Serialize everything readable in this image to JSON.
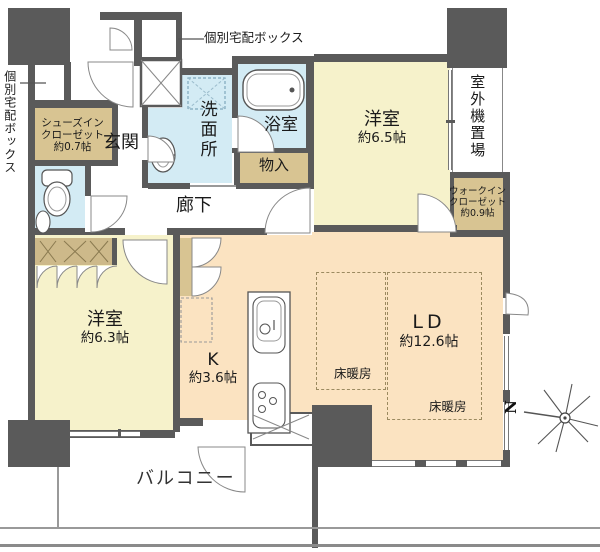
{
  "palette": {
    "wall": "#5a5a5a",
    "bedroom_yellow": "#f6f2cb",
    "ldk_peach": "#fbe3c1",
    "wet_area_blue": "#d3ebf4",
    "closet_tan": "#d8c492",
    "outline_gray": "#777777"
  },
  "plan": {
    "delivery_box_top": "個別宅配ボックス",
    "delivery_box_left": "個別宅配ボックス",
    "entrance": "玄関",
    "shoes_closet": {
      "l1": "シューズイン",
      "l2": "クローゼット",
      "l3": "約0.7帖"
    },
    "washroom": "洗面所",
    "bathroom": "浴室",
    "storage": "物入",
    "corridor": "廊下",
    "bedroom1": {
      "name": "洋室",
      "size": "約6.5帖"
    },
    "outdoor_unit": "室外機置場",
    "wic": {
      "l1": "ウォークイン",
      "l2": "クローゼット",
      "l3": "約0.9帖"
    },
    "bedroom2": {
      "name": "洋室",
      "size": "約6.3帖"
    },
    "kitchen": {
      "name": "K",
      "size": "約3.6帖"
    },
    "living_dining": {
      "name": "LD",
      "size": "約12.6帖"
    },
    "floor_heating_1": "床暖房",
    "floor_heating_2": "床暖房",
    "balcony": "バルコニー",
    "compass_north": "N"
  }
}
